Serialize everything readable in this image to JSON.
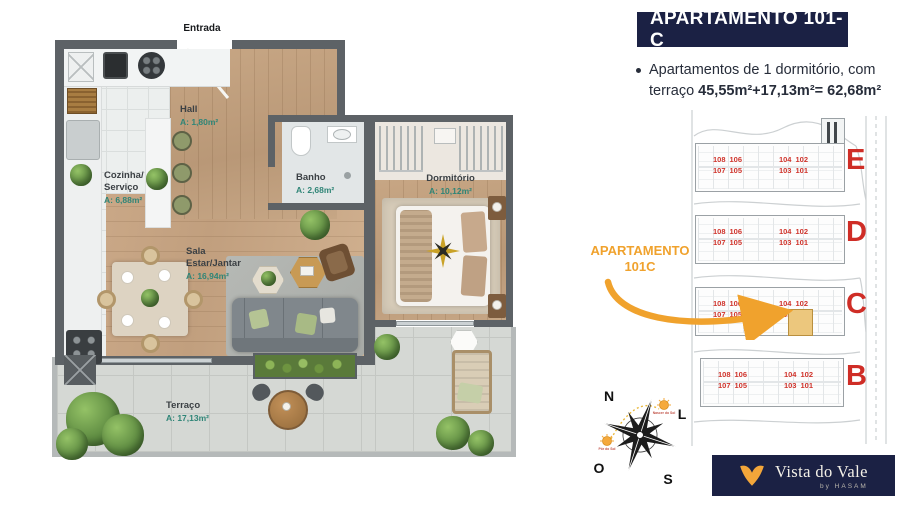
{
  "panel": {
    "title": "APARTAMENTO 101-C",
    "bullet": {
      "line1": "Apartamentos de 1 dormitório, com",
      "line2_prefix": "terraço ",
      "line2_bold": "45,55m²+17,13m²= 62,68m²"
    }
  },
  "floorplan": {
    "entrance": "Entrada",
    "rooms": [
      {
        "label": "Hall",
        "area": "A: 1,80m²"
      },
      {
        "label": "Cozinha/\nServiço",
        "area": "A: 6,88m²"
      },
      {
        "label": "Banho",
        "area": "A: 2,68m²"
      },
      {
        "label": "Dormitório",
        "area": "A: 10,12m²"
      },
      {
        "label": "Sala\nEstar/Jantar",
        "area": "A: 16,94m²"
      },
      {
        "label": "Terraço",
        "area": "A: 17,13m²"
      }
    ]
  },
  "sitemap": {
    "callout": {
      "line1": "APARTAMENTO",
      "line2": "101C"
    },
    "buildings": [
      {
        "letter": "E",
        "top": [
          "108",
          "106",
          "104",
          "102"
        ],
        "bottom": [
          "107",
          "105",
          "103",
          "101"
        ]
      },
      {
        "letter": "D",
        "top": [
          "108",
          "106",
          "104",
          "102"
        ],
        "bottom": [
          "107",
          "105",
          "103",
          "101"
        ]
      },
      {
        "letter": "C",
        "top": [
          "108",
          "106",
          "104",
          "102"
        ],
        "bottom": [
          "107",
          "105",
          "103",
          "101"
        ],
        "highlighted_unit": "101"
      },
      {
        "letter": "B",
        "top": [
          "108",
          "106",
          "104",
          "102"
        ],
        "bottom": [
          "107",
          "105",
          "103",
          "101"
        ]
      }
    ]
  },
  "compass": {
    "north": "N",
    "east": "L",
    "south": "S",
    "west": "O",
    "sunrise": "Nascer do Sol",
    "sunset": "Pôr do Sol"
  },
  "logo": {
    "brand": "Vista do Vale",
    "byline": "by HASAM"
  },
  "colors": {
    "navy": "#1b2144",
    "orange": "#f0a22d",
    "red": "#d0342c",
    "area_teal": "#2f8577",
    "highlight": "#ecc77d"
  }
}
